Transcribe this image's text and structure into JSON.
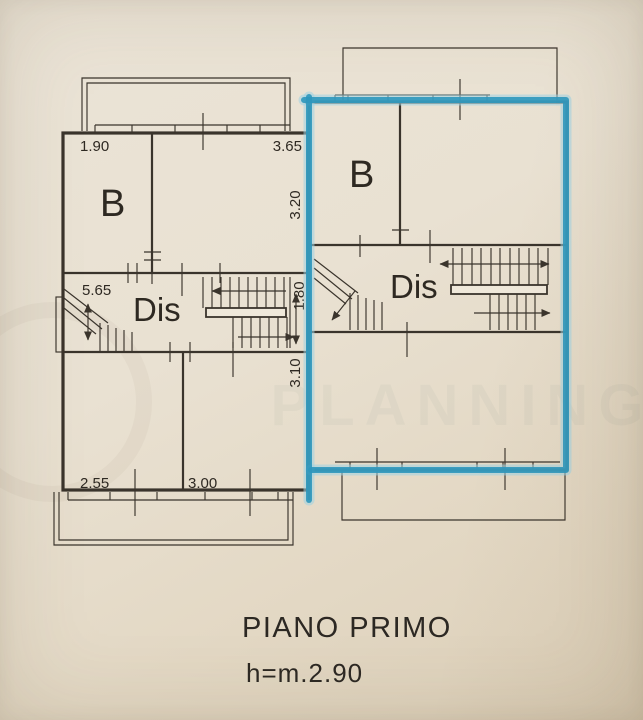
{
  "title_block": {
    "floor_label": "PIANO PRIMO",
    "height_label": "h=m.2.90"
  },
  "watermark": {
    "text": "PLANNING"
  },
  "colors": {
    "paper": "#e9e1d2",
    "ink": "#3a342c",
    "label_text": "#2e2922",
    "highlight_marker": "#2e97bc"
  },
  "left_unit": {
    "room_labels": {
      "bathroom": "B",
      "hallway": "Dis"
    },
    "dimensions": {
      "top_left_width": "1.90",
      "top_right_width": "3.65",
      "middle_width": "5.65",
      "bottom_left_width": "2.55",
      "bottom_middle_width": "3.00"
    }
  },
  "right_unit": {
    "highlighted": true,
    "room_labels": {
      "bathroom": "B",
      "hallway": "Dis"
    }
  },
  "center_dimensions": {
    "top_depth": "3.20",
    "stair_depth": "1.80",
    "bottom_depth": "3.10"
  }
}
